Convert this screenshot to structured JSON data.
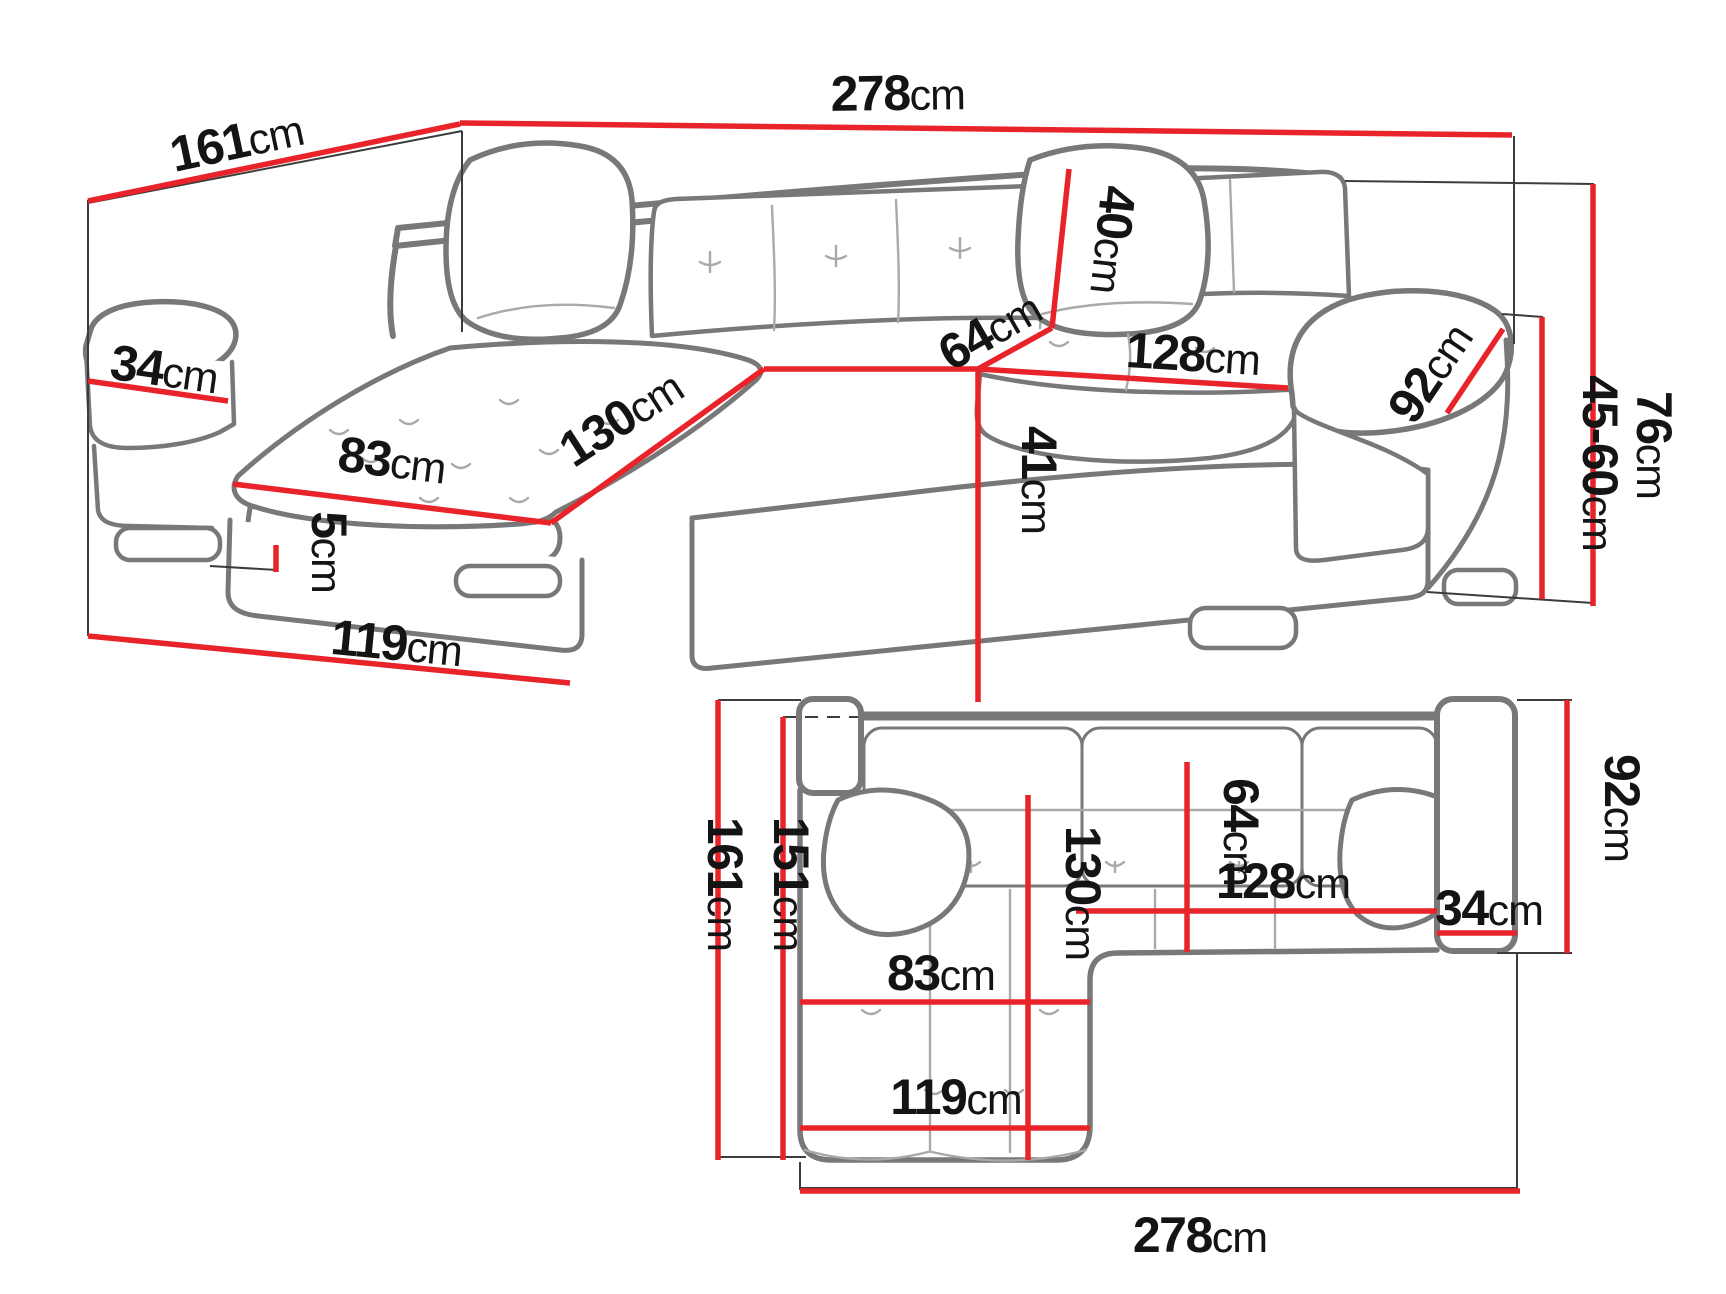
{
  "colors": {
    "dimension_red": "#e8242a",
    "sofa_outline_gray": "#787878",
    "text_black": "#141414",
    "background": "#ffffff"
  },
  "views": {
    "perspective": {
      "dims": {
        "width_total": {
          "value": "278",
          "unit": "cm"
        },
        "depth_total": {
          "value": "161",
          "unit": "cm"
        },
        "armrest_width": {
          "value": "34",
          "unit": "cm"
        },
        "chaise_seat_width": {
          "value": "83",
          "unit": "cm"
        },
        "chaise_seat_length": {
          "value": "130",
          "unit": "cm"
        },
        "backrest_height": {
          "value": "40",
          "unit": "cm"
        },
        "seat_depth": {
          "value": "64",
          "unit": "cm"
        },
        "seat_width": {
          "value": "128",
          "unit": "cm"
        },
        "armrest_length": {
          "value": "92",
          "unit": "cm"
        },
        "seat_height": {
          "value": "41",
          "unit": "cm"
        },
        "height_total": {
          "value": "76",
          "unit": "cm"
        },
        "headrest_height_range": {
          "value": "45-60",
          "unit": "cm"
        },
        "leg_height": {
          "value": "5",
          "unit": "cm"
        },
        "chaise_depth": {
          "value": "119",
          "unit": "cm"
        }
      }
    },
    "plan": {
      "dims": {
        "depth_total": {
          "value": "161",
          "unit": "cm"
        },
        "depth_inner": {
          "value": "151",
          "unit": "cm"
        },
        "chaise_length": {
          "value": "130",
          "unit": "cm"
        },
        "seat_depth": {
          "value": "64",
          "unit": "cm"
        },
        "seat_width": {
          "value": "128",
          "unit": "cm"
        },
        "armrest_width": {
          "value": "34",
          "unit": "cm"
        },
        "armrest_depth": {
          "value": "92",
          "unit": "cm"
        },
        "chaise_seat_width": {
          "value": "83",
          "unit": "cm"
        },
        "chaise_width": {
          "value": "119",
          "unit": "cm"
        },
        "width_total": {
          "value": "278",
          "unit": "cm"
        }
      }
    }
  }
}
